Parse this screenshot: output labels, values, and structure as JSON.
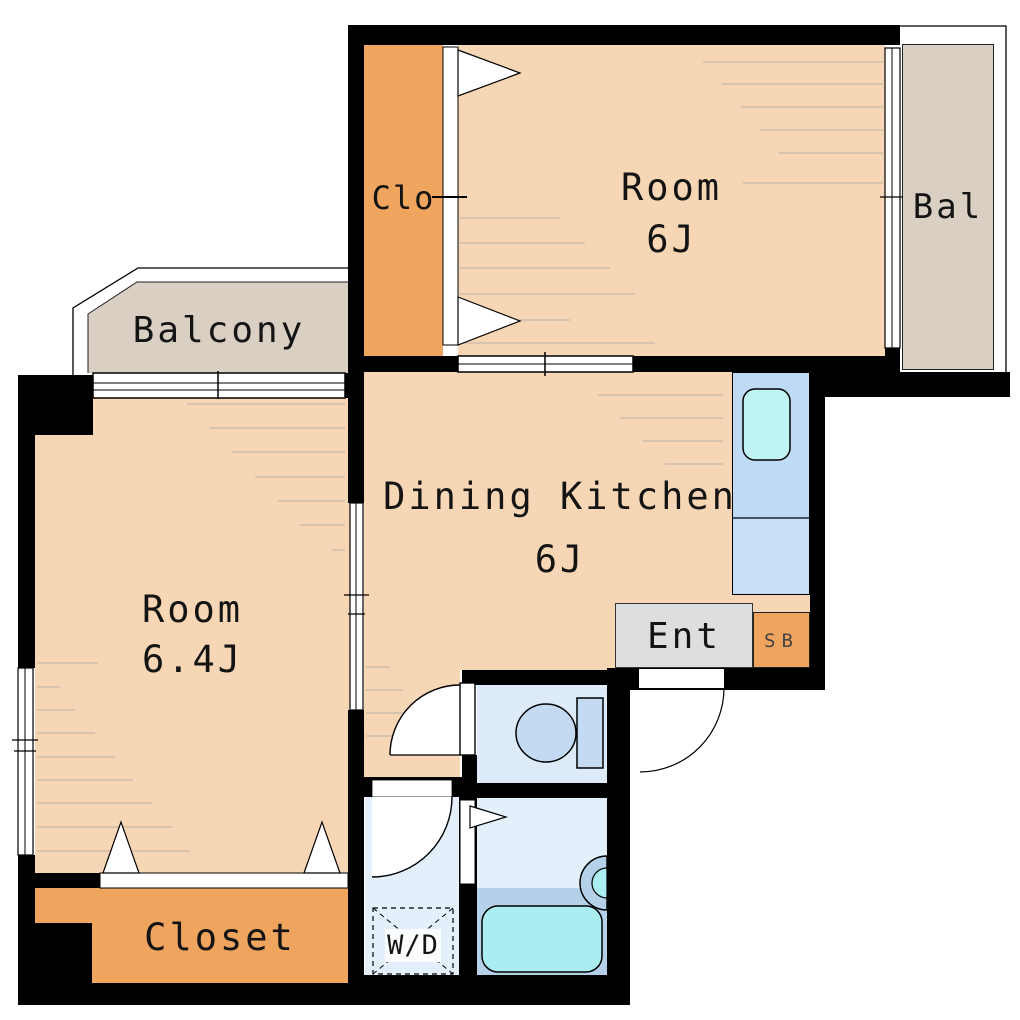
{
  "plan": {
    "rooms": {
      "bedroom_top": {
        "label": "Room",
        "size": "6J"
      },
      "bedroom_left": {
        "label": "Room",
        "size": "6.4J"
      },
      "dining_kitchen": {
        "label": "Dining Kitchen",
        "size": "6J"
      },
      "balcony_top_left": {
        "label": "Balcony"
      },
      "balcony_right": {
        "label": "Bal"
      },
      "closet_top": {
        "label": "Clo"
      },
      "closet_bottom": {
        "label": "Closet"
      },
      "entrance": {
        "label": "Ent"
      },
      "shoe_box": {
        "label": "SB"
      },
      "washer_dryer": {
        "label": "W/D"
      }
    },
    "fixtures": {
      "toilet": "toilet-icon",
      "bathtub": "bathtub-icon",
      "kitchen_sink": "kitchen-sink-icon",
      "bath_faucet": "bath-faucet-icon",
      "washer_dryer_space": "washer-dryer-dashed-box"
    },
    "colors": {
      "wall": "#000000",
      "room-fill": "#f6d6b4",
      "closet-fill": "#efa55e",
      "balcony-fill": "#d9cfc3",
      "wet-fill": "#e3effb",
      "toilet-room-fill": "#ddebf8",
      "counter-fill": "#bedaf4",
      "counter-fill-2": "#c9e0f6",
      "sink-fill": "#c0f4f4",
      "tub-fill": "#abeef2",
      "toilet-fill": "#c3daf2",
      "deck-fill": "#b5d0e9",
      "entrance-fill": "#dcdedf",
      "floor-line": "#b9b2a8"
    }
  }
}
